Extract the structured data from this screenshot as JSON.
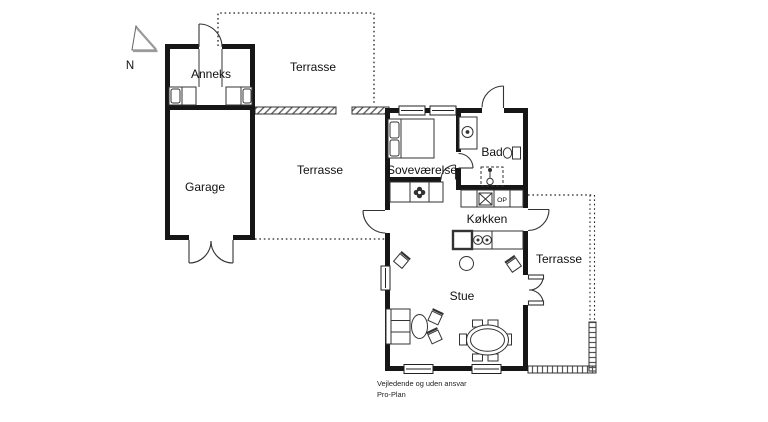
{
  "plan": {
    "type": "floor-plan",
    "compass": {
      "north": "N"
    },
    "rooms": {
      "anneks": "Anneks",
      "garage": "Garage",
      "sovevaerelse": "Soveværelse",
      "bad": "Bad",
      "koekken": "Køkken",
      "stue": "Stue"
    },
    "terraces": {
      "north": "Terrasse",
      "west": "Terrasse",
      "east": "Terrasse"
    },
    "kitchen": {
      "op_label": "OP"
    },
    "footer": {
      "disclaimer": "Vejledende og uden ansvar",
      "brand": "Pro-Plan"
    },
    "colors": {
      "wall": "#161616",
      "line": "#2b2b2b",
      "hatch": "#555555",
      "background": "#ffffff"
    }
  }
}
